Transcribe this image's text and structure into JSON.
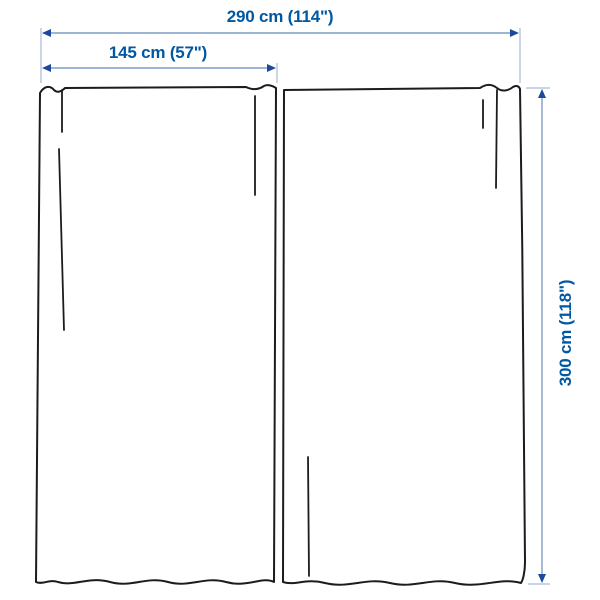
{
  "diagram": {
    "title": "Curtain pair dimension diagram",
    "product_type": "curtains-2-panels",
    "labels": {
      "total_width": "290 cm (114\")",
      "panel_width": "145 cm (57\")",
      "height": "300 cm (118\")"
    },
    "measurements": {
      "total_width_cm": 290,
      "total_width_in": 114,
      "panel_width_cm": 145,
      "panel_width_in": 57,
      "height_cm": 300,
      "height_in": 118,
      "panel_count": 2
    },
    "colors": {
      "label_text": "#0058a3",
      "dimension_line": "#7f9dc7",
      "extension_line": "#a8bcd9",
      "arrowhead": "#1b4a9b",
      "curtain_outline": "#1c1c1c",
      "background": "#ffffff"
    }
  }
}
